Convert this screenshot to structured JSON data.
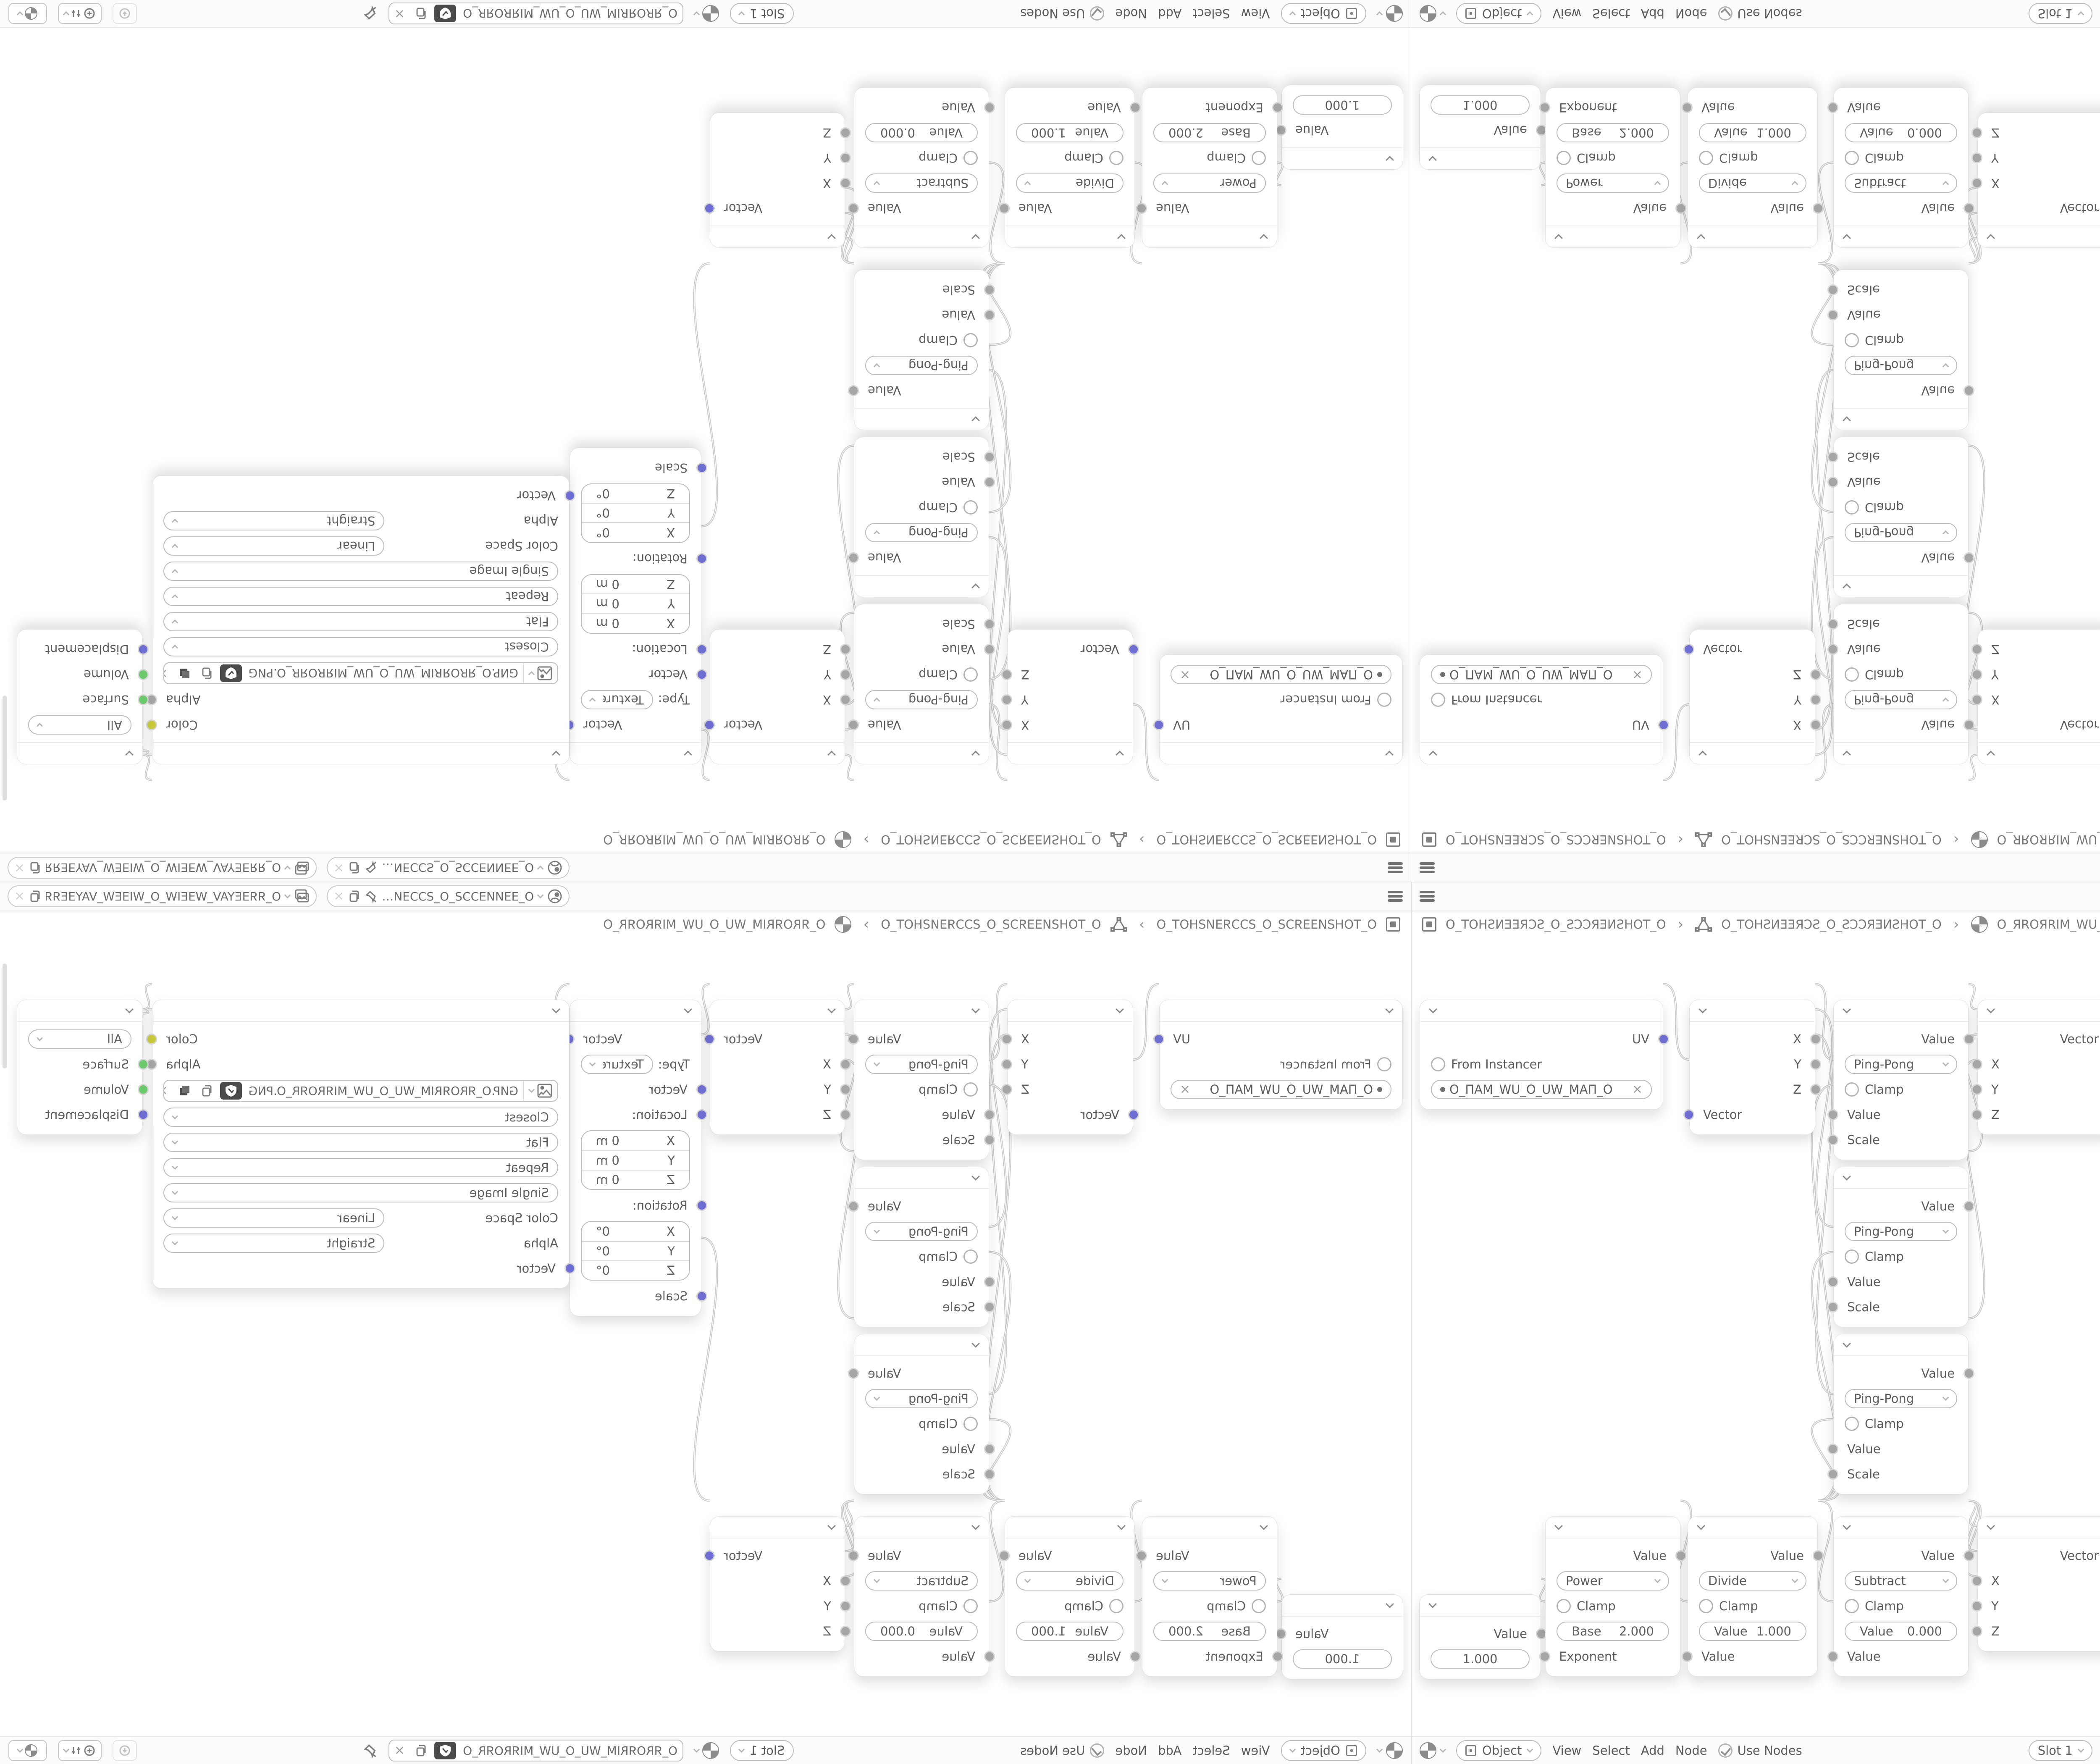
{
  "window": {
    "topbar": {
      "scene_value": "O_ƎƎИИƎƆƆƧ_O_ƧƆƆƎИ…",
      "view_layer_value": "O_ЯЯƎEYAV_WƎEIW_O_WIƎEW_VAYƎEЯЯ_O"
    },
    "breadcrumb": {
      "scene": "O_TOHƧИƎƎЯƆƧ_O_ƧƆƆЯƎИƧHOT_O",
      "object": "O_TOHƧИƎƎЯƆƧ_O_ƧƆƆЯƎИƧHOT_O",
      "material": "O_ЯROЯRIM_WU_O_UW_MIЯROЯR_O",
      "separator": "›"
    },
    "footer": {
      "shader_type": "Object",
      "menus": [
        "View",
        "Select",
        "Add",
        "Node"
      ],
      "use_nodes": "Use Nodes",
      "slot": "Slot 1",
      "image_name": "O_ЯROЯRIM_WU_O_UW_MIЯROЯR_O",
      "unlink": "×"
    }
  },
  "nodes": {
    "uv_map": {
      "out": "UV",
      "from_instancer": "From Instancer",
      "uv_map_name": "O_ПAM_WU_O_UW_MAП_O",
      "clear": "×"
    },
    "separate_xyz": {
      "x": "X",
      "y": "Y",
      "z": "Z",
      "vector": "Vector"
    },
    "ping_pong": {
      "out": "Value",
      "operation": "Ping-Pong",
      "clamp": "Clamp",
      "value": "Value",
      "scale": "Scale"
    },
    "combine_xyz": {
      "out": "Vector",
      "x": "X",
      "y": "Y",
      "z": "Z"
    },
    "mapping": {
      "out": "Vector",
      "type_label": "Type:",
      "type": "Texture",
      "vector": "Vector",
      "location_label": "Location:",
      "rotation_label": "Rotation:",
      "scale_label": "Scale",
      "axis_x": "X",
      "axis_y": "Y",
      "axis_z": "Z",
      "loc_x": "0 m",
      "loc_y": "0 m",
      "loc_z": "0 m",
      "rot_x": "0°",
      "rot_y": "0°",
      "rot_z": "0°"
    },
    "image_texture": {
      "color_out": "Color",
      "alpha_out": "Alpha",
      "filename": "GИP.O_ЯROЯRIM_WU_O_UW_MIЯROЯR_O.PNG",
      "interpolation": "Closest",
      "projection": "Flat",
      "extension": "Repeat",
      "source": "Single Image",
      "color_space_label": "Color Space",
      "color_space": "Linear",
      "alpha_label": "Alpha",
      "alpha_mode": "Straight",
      "vector_in": "Vector",
      "unlink": "×"
    },
    "material_output": {
      "target": "All",
      "surface": "Surface",
      "volume": "Volume",
      "displacement": "Displacement"
    },
    "value": {
      "out": "Value",
      "value": "1.000"
    },
    "power": {
      "out": "Value",
      "operation": "Power",
      "clamp": "Clamp",
      "base_label": "Base",
      "base_value": "2.000",
      "exponent": "Exponent"
    },
    "divide": {
      "out": "Value",
      "operation": "Divide",
      "clamp": "Clamp",
      "value_label": "Value",
      "value": "1.000",
      "value_in": "Value"
    },
    "subtract": {
      "out": "Value",
      "operation": "Subtract",
      "clamp": "Clamp",
      "value_label": "Value",
      "value": "0.000",
      "value_in": "Value"
    }
  },
  "colors": {
    "socket_vector": "#6e6ed2",
    "socket_value": "#a6a6a6",
    "socket_color": "#c9c93a",
    "socket_shader": "#6cc96c",
    "wire": "#c6c6c6",
    "bar_background": "#fbfbfb"
  }
}
